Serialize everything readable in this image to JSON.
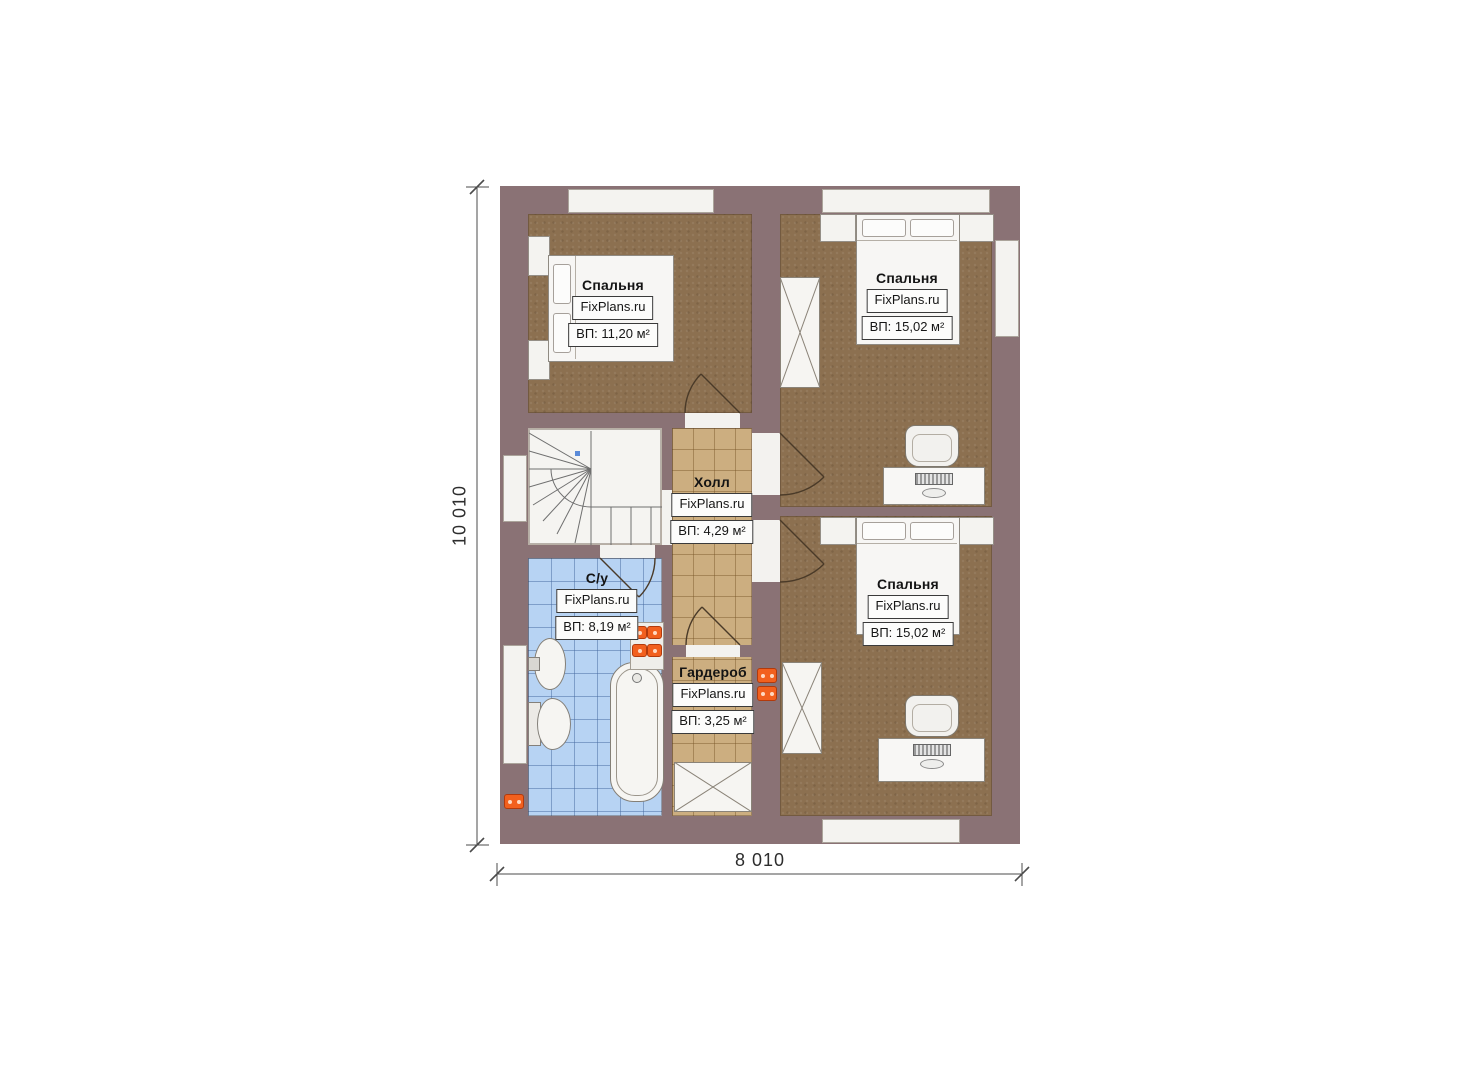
{
  "plan": {
    "type": "floor-plan",
    "source_watermark": "FixPlans.ru"
  },
  "dimensions": {
    "height_label": "10 010",
    "width_label": "8 010"
  },
  "rooms": [
    {
      "id": "bedroom-top-left",
      "name": "Спальня",
      "brand": "FixPlans.ru",
      "area": "ВП: 11,20 м²"
    },
    {
      "id": "bedroom-top-right",
      "name": "Спальня",
      "brand": "FixPlans.ru",
      "area": "ВП: 15,02 м²"
    },
    {
      "id": "bedroom-bottom-right",
      "name": "Спальня",
      "brand": "FixPlans.ru",
      "area": "ВП: 15,02 м²"
    },
    {
      "id": "hall",
      "name": "Холл",
      "brand": "FixPlans.ru",
      "area": "ВП: 4,29 м²"
    },
    {
      "id": "bathroom",
      "name": "С/у",
      "brand": "FixPlans.ru",
      "area": "ВП: 8,19 м²"
    },
    {
      "id": "wardrobe",
      "name": "Гардероб",
      "brand": "FixPlans.ru",
      "area": "ВП: 3,25 м²"
    }
  ],
  "colors": {
    "wall": "#8a7275",
    "wood_floor": "#8c7050",
    "tile_tan": "#ccae80",
    "tile_blue": "#b7d3f3",
    "fixture_white": "#f6f5f2",
    "radiator_orange": "#f2601e",
    "door_line": "#4a3a28",
    "dimension_line": "#444444"
  }
}
